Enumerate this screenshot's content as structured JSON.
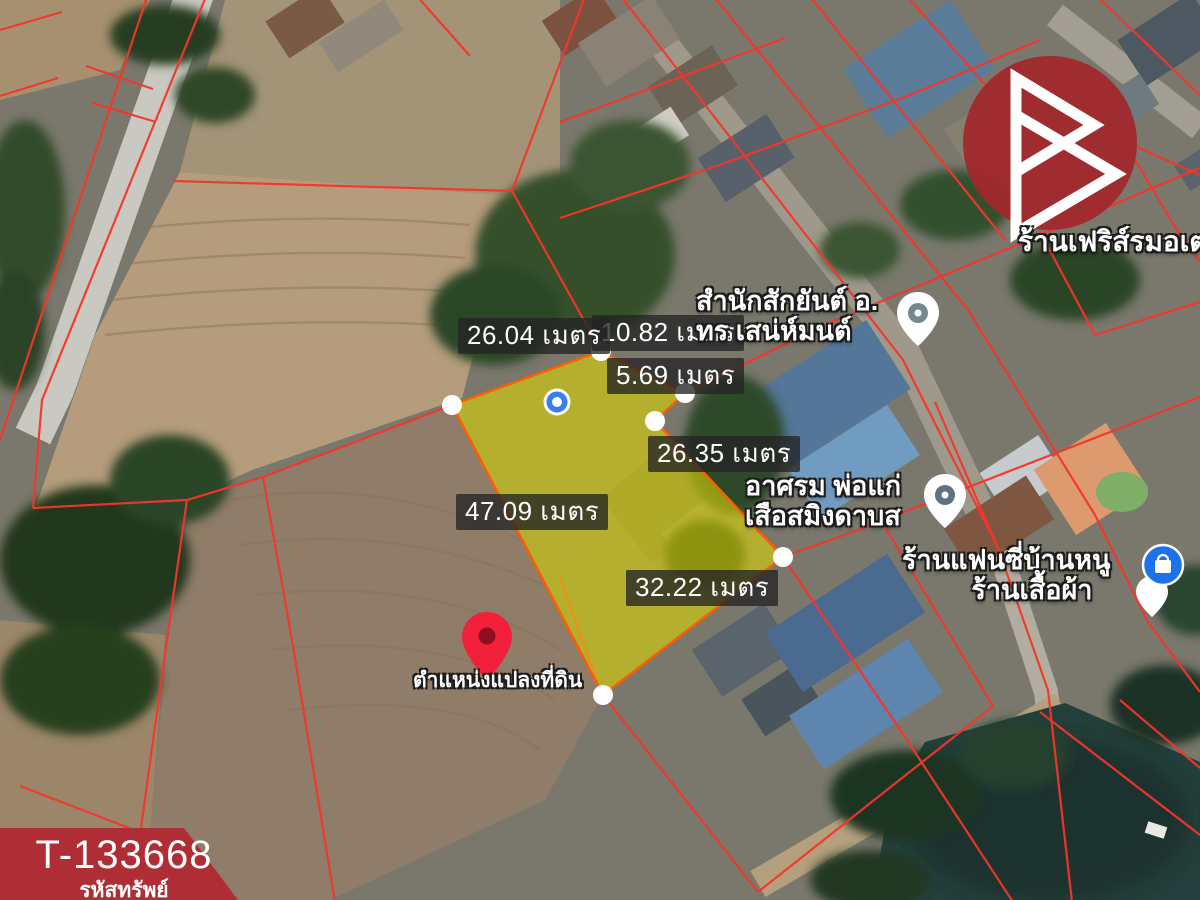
{
  "image_type": "land-plot-satellite-annotation",
  "measurements": {
    "m_top": "26.04 เมตร",
    "m_topright": "10.82 เมตร",
    "m_notch": "5.69 เมตร",
    "m_right": "26.35 เมตร",
    "m_left": "47.09 เมตร",
    "m_bottom": "32.22 เมตร"
  },
  "poi": {
    "ferris_shop": "ร้านเฟริส์รมอเต",
    "tattoo_line1": "สำนักสักยันต์ อ.",
    "tattoo_line2": "ทร เสน่ห์มนต์",
    "ashram_line1": "อาศรม พ่อแก่",
    "ashram_line2": "เสือสมิงดาบส",
    "fancy_line1": "ร้านแฟนซี่บ้านหนู",
    "fancy_line2": "ร้านเสื้อผ้า"
  },
  "plot": {
    "pin_label": "ตำแหน่งแปลงที่ดิน"
  },
  "property": {
    "code": "T-133668",
    "caption": "รหัสทรัพย์"
  },
  "colors": {
    "parcel_line": "#f5352b",
    "plot_fill": "#e6dc00",
    "plot_stroke": "#ff5d00",
    "brand_red": "#a1272c",
    "ribbon_red": "#af2e35",
    "poi_blue": "#1a73e8",
    "gps_blue": "#3b7df0",
    "land_pin_red": "#f2203a"
  }
}
